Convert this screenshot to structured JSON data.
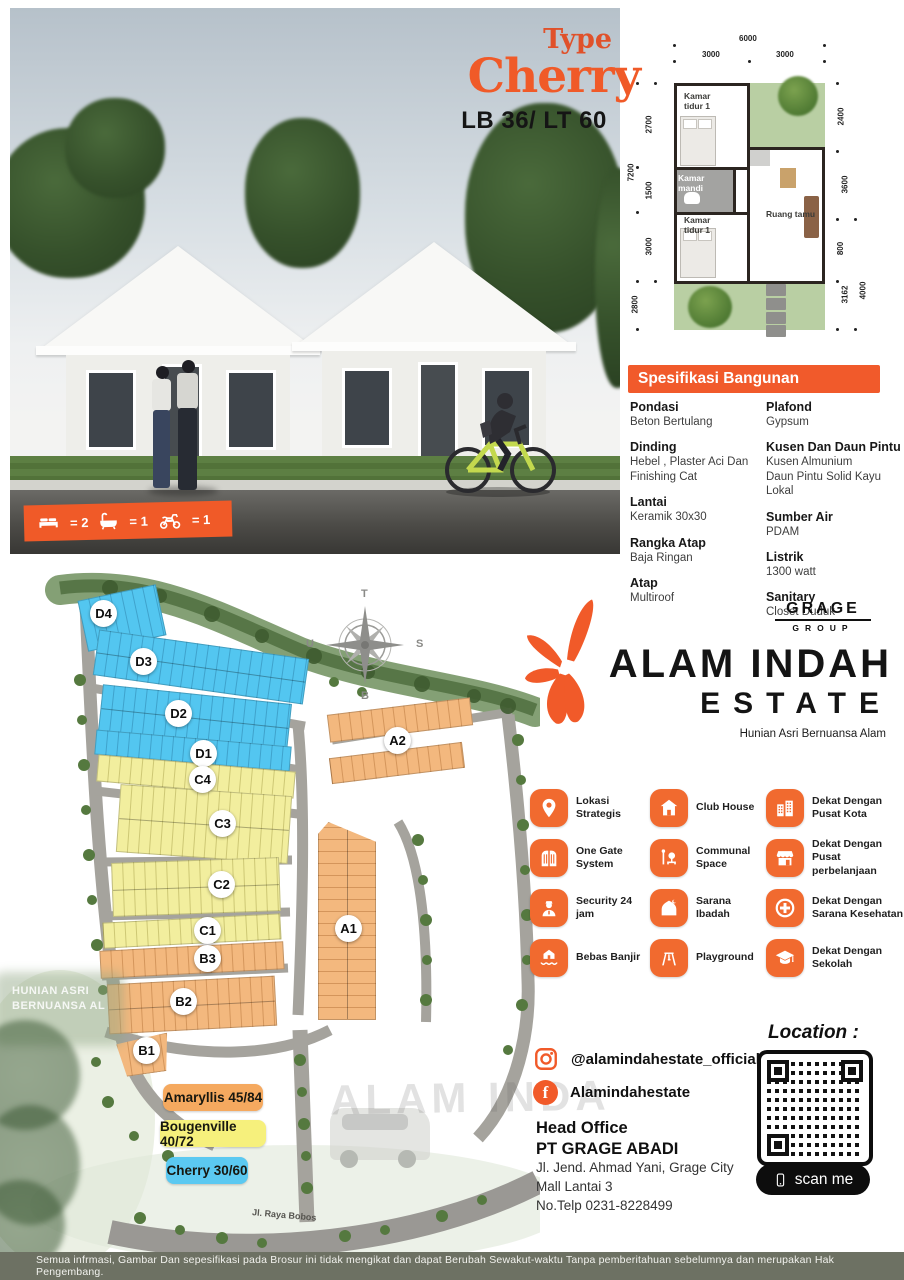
{
  "title": {
    "type_label": "Type",
    "type_name": "Cherry",
    "size": "LB 36/ LT 60"
  },
  "photo": {
    "bed_count": "= 2",
    "bath_count": "= 1",
    "moto_count": "= 1"
  },
  "floorplan": {
    "dim_top_total": "6000",
    "dim_top_left": "3000",
    "dim_top_right": "3000",
    "dim_left_outer": "7200",
    "dims_left": [
      "2700",
      "1500",
      "3000",
      "2800"
    ],
    "dims_right": [
      "2400",
      "3600",
      "800",
      "3162",
      "4000"
    ],
    "rooms": {
      "bed1": "Kamar tidur 1",
      "bath": "Kamar mandi",
      "bed2": "Kamar tidur 1",
      "living": "Ruang tamu"
    }
  },
  "spec": {
    "title": "Spesifikasi Bangunan",
    "left": [
      {
        "label": "Pondasi",
        "value": "Beton Bertulang"
      },
      {
        "label": "Dinding",
        "value": "Hebel , Plaster Aci Dan\nFinishing Cat"
      },
      {
        "label": "Lantai",
        "value": "Keramik 30x30"
      },
      {
        "label": "Rangka Atap",
        "value": "Baja Ringan"
      },
      {
        "label": "Atap",
        "value": "Multiroof"
      }
    ],
    "right": [
      {
        "label": "Plafond",
        "value": "Gypsum"
      },
      {
        "label": "Kusen Dan Daun Pintu",
        "value": "Kusen Almunium\nDaun Pintu  Solid Kayu Lokal"
      },
      {
        "label": "Sumber Air",
        "value": "PDAM"
      },
      {
        "label": "Listrik",
        "value": "1300 watt"
      },
      {
        "label": "Sanitary",
        "value": "Closet Duduk"
      }
    ]
  },
  "siteplan": {
    "compass": {
      "top": "T",
      "left": "U",
      "right": "S",
      "bottom": "B"
    },
    "blocks": [
      {
        "label": "D4"
      },
      {
        "label": "D3"
      },
      {
        "label": "D2"
      },
      {
        "label": "D1"
      },
      {
        "label": "C4"
      },
      {
        "label": "C3"
      },
      {
        "label": "C2"
      },
      {
        "label": "C1"
      },
      {
        "label": "B3"
      },
      {
        "label": "B2"
      },
      {
        "label": "B1"
      },
      {
        "label": "A1"
      },
      {
        "label": "A2"
      }
    ],
    "legend": [
      {
        "label": "Amaryllis 45/84",
        "color": "#F5A95F"
      },
      {
        "label": "Bougenville 40/72",
        "color": "#F6F07C"
      },
      {
        "label": "Cherry 30/60",
        "color": "#5BC9F1"
      }
    ],
    "road_label": "Jl. Raya Bobos",
    "watermark_left": "HUNIAN ASRI\nBERNUANSA AL",
    "watermark_gate": "ALAM INDA"
  },
  "brand": {
    "group_name": "GRAGE",
    "group_sub": "GROUP",
    "estate_line1": "ALAM INDAH",
    "estate_line2": "ESTATE",
    "tagline": "Hunian Asri Bernuansa Alam"
  },
  "features": {
    "cols": [
      [
        {
          "icon": "location-pin",
          "label": "Lokasi Strategis"
        },
        {
          "icon": "gate",
          "label": "One Gate System"
        },
        {
          "icon": "security-guard",
          "label": "Security 24 jam"
        },
        {
          "icon": "flood-free",
          "label": "Bebas Banjir"
        }
      ],
      [
        {
          "icon": "club-house",
          "label": "Club House"
        },
        {
          "icon": "communal-space",
          "label": "Communal Space"
        },
        {
          "icon": "mosque",
          "label": "Sarana Ibadah"
        },
        {
          "icon": "playground",
          "label": "Playground"
        }
      ],
      [
        {
          "icon": "city-buildings",
          "label": "Dekat Dengan Pusat Kota"
        },
        {
          "icon": "shop-awning",
          "label": "Dekat Dengan Pusat perbelanjaan"
        },
        {
          "icon": "health-cross",
          "label": "Dekat Dengan Sarana Kesehatan"
        },
        {
          "icon": "graduation-cap",
          "label": "Dekat Dengan Sekolah"
        }
      ]
    ]
  },
  "contact": {
    "instagram": "@alamindahestate_official",
    "facebook": "Alamindahestate",
    "office_title": "Head Office",
    "company": "PT GRAGE ABADI",
    "address_line1": "Jl. Jend. Ahmad Yani, Grage City",
    "address_line2": "Mall Lantai 3",
    "phone": "No.Telp 0231-8228499"
  },
  "location": {
    "label": "Location :",
    "scan_label": "scan me"
  },
  "footer": {
    "disclaimer": "Semua infrmasi, Gambar Dan sepesifikasi pada Brosur ini tidak mengikat dan dapat Berubah Sewakut-waktu Tanpa pemberitahuan sebelumnya dan merupakan Hak Pengembang."
  },
  "colors": {
    "accent": "#F15A29",
    "lot_blue": "#53C6F0",
    "lot_yellow": "#F2EE9E",
    "lot_orange": "#F3B87E"
  }
}
